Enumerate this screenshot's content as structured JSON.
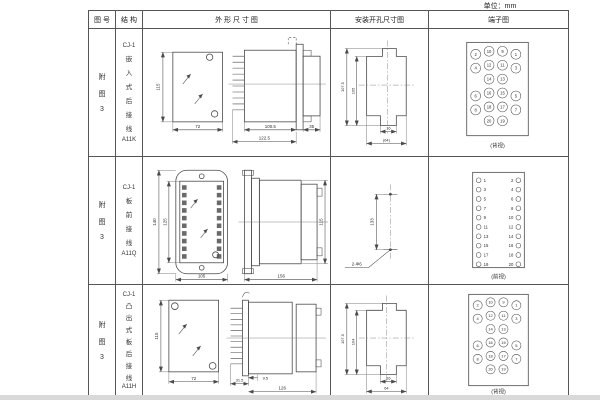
{
  "unit_label": "单位：mm",
  "table": {
    "headers": [
      "图 号",
      "结 构",
      "外 形 尺 寸 图",
      "安装开孔尺寸图",
      "端子图"
    ]
  },
  "colors": {
    "line": "#4a4a4a",
    "text": "#333333",
    "border": "#555555",
    "bg": "#ffffff"
  },
  "rows": [
    {
      "fig_chars": [
        "附",
        "图",
        "3"
      ],
      "structure": {
        "model": "CJ-1",
        "chars": [
          "嵌",
          "入",
          "式",
          "后",
          "接",
          "线"
        ],
        "code": "A11K"
      },
      "outline": {
        "height": "115",
        "width": "72",
        "body_depth": "100.5",
        "total_depth": "122.5",
        "rear_depth": "35"
      },
      "install": {
        "outer_height": "107.5",
        "inner_height": "105",
        "slot_width": "16",
        "width": "(64)"
      },
      "terminal": {
        "view": "(背视)",
        "outer_left": [
          2,
          4,
          6,
          8
        ],
        "inner_left": [
          10,
          12,
          14,
          16,
          18,
          20
        ],
        "inner_right": [
          9,
          11,
          13,
          15,
          17,
          19
        ],
        "outer_right": [
          1,
          3,
          5,
          7
        ]
      }
    },
    {
      "fig_chars": [
        "附",
        "图",
        "3"
      ],
      "structure": {
        "model": "CJ-1",
        "chars": [
          "板",
          "前",
          "接",
          "线"
        ],
        "code": "A11Q"
      },
      "outline": {
        "outer_height": "140",
        "inner_height": "125",
        "width": "105",
        "total_depth": "156",
        "side_height": "115"
      },
      "install": {
        "hole_spacing": "133",
        "holes": "2-Φ6"
      },
      "terminal": {
        "view": "(前视)",
        "pairs": [
          [
            1,
            2
          ],
          [
            3,
            4
          ],
          [
            5,
            6
          ],
          [
            7,
            8
          ],
          [
            9,
            10
          ],
          [
            11,
            12
          ],
          [
            13,
            14
          ],
          [
            15,
            16
          ],
          [
            17,
            18
          ],
          [
            19,
            20
          ]
        ]
      }
    },
    {
      "fig_chars": [
        "附",
        "图",
        "3"
      ],
      "structure": {
        "model": "CJ-1",
        "chars": [
          "凸",
          "出",
          "式",
          "板",
          "后",
          "接",
          "线"
        ],
        "code": "A11H"
      },
      "outline": {
        "height": "115",
        "width": "72",
        "comb_depth": "31.5",
        "step": "9.5",
        "total_depth": "126"
      },
      "install": {
        "outer_height": "107.5",
        "inner_height": "104",
        "slot_width": "16",
        "width": "64"
      },
      "terminal": {
        "view": "(背视)",
        "outer_left": [
          2,
          4,
          6,
          8
        ],
        "inner_left": [
          10,
          12,
          14,
          16,
          18,
          20
        ],
        "inner_right": [
          9,
          11,
          13,
          15,
          17,
          19
        ],
        "outer_right": [
          1,
          3,
          5,
          7
        ]
      }
    }
  ]
}
